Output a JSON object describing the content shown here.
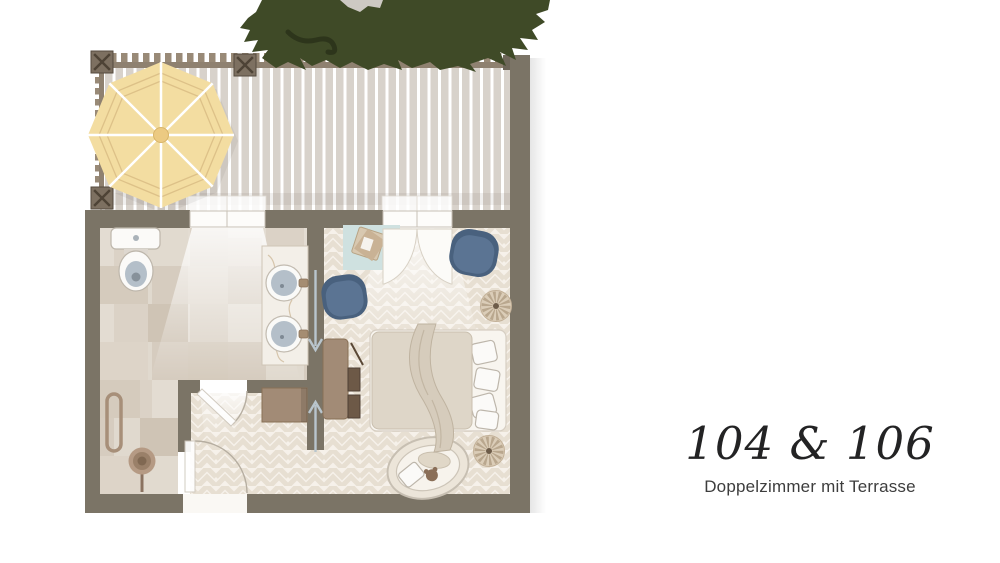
{
  "caption": {
    "title": "104 & 106",
    "subtitle": "Doppelzimmer mit Terrasse"
  },
  "plan": {
    "rooms": [
      "terrace",
      "bathroom",
      "entry-hall",
      "bedroom"
    ],
    "furniture": [
      "parasol",
      "tree",
      "toilet",
      "double-vanity-sinks",
      "towel-rail",
      "plant",
      "wardrobe-cabinet",
      "desk",
      "blue-pouf",
      "blue-pouf",
      "side-mat-with-tray",
      "rattan-stool",
      "rattan-stool",
      "double-bed",
      "throw-blanket",
      "pet-bed",
      "french-door-curtains",
      "terrace-railing"
    ]
  },
  "colors": {
    "wall": "#7b7466",
    "deck": "#d8d2cb",
    "rail": "#8f8170",
    "post": "#7d7061",
    "parasol": "#f3dda1",
    "parasol_line": "#ddc188",
    "tree": "#3f4a27",
    "tree_dark": "#2d351b",
    "tile": "#e3dcd2",
    "floor": "#f6f1ea",
    "floor_line": "#e7dfd2",
    "accent_blue": "#5b7493",
    "accent_blue_dark": "#49617e",
    "wood": "#a28b76",
    "wood_dark": "#6d5947",
    "bed_duvet": "#ded6c8",
    "bed_throw": "#d6ccbc",
    "marble": "#f3efe8",
    "sink": "#b4bfc9",
    "mat_blue": "#cfe1e0",
    "rattan": "#dbcdb8",
    "text": "#232324",
    "subtext": "#3d3d3d"
  }
}
